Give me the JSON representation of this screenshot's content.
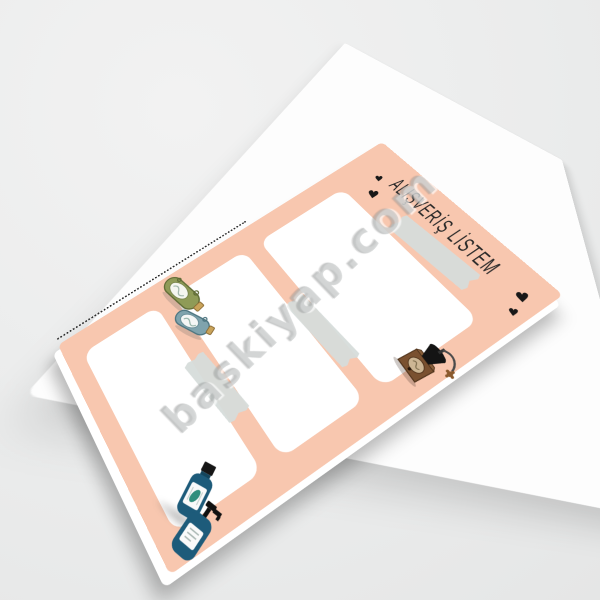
{
  "scene": {
    "type": "product mockup photo of a notepad",
    "background_color": "#ececec",
    "backing_sheet_color": "#fdfdfd"
  },
  "notepad": {
    "title": "ALIŞVERİŞ LİSTEM",
    "heart_glyph": "♥",
    "base_color": "#f8c7af",
    "panel_color": "#ffffff",
    "tape_color": "#d6dcda",
    "panel_count": 3,
    "decorations": [
      "heart-icon",
      "heart-icon",
      "heart-icon",
      "heart-icon",
      "green-flask-icon",
      "blue-flask-icon",
      "coffee-grinder-icon",
      "shampoo-bottle-icon",
      "pump-bottle-icon",
      "washi-tape",
      "washi-tape",
      "washi-tape",
      "perforation-dots"
    ]
  },
  "watermark": {
    "text": "baskiyap.com"
  }
}
